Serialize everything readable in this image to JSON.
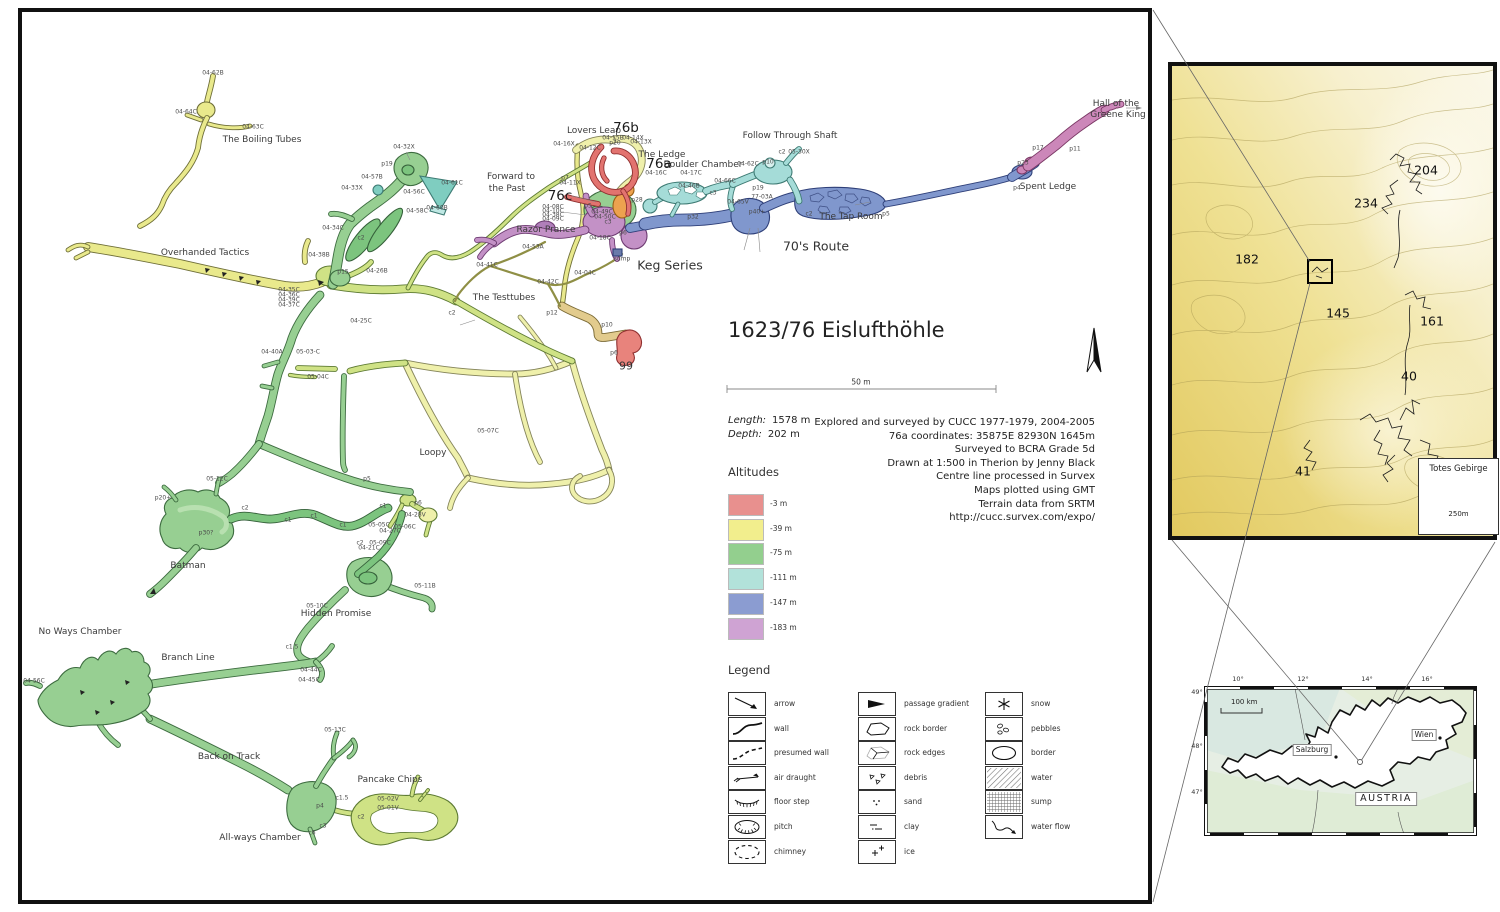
{
  "main_map": {
    "title": "1623/76 Eislufthöhle",
    "scale_label": "50 m",
    "stats": {
      "length_label": "Length:",
      "length_value": "1578 m",
      "depth_label": "Depth:",
      "depth_value": "202 m"
    },
    "credits": [
      "Explored and surveyed by CUCC 1977-1979, 2004-2005",
      "76a coordinates: 35875E 82930N 1645m",
      "Surveyed to BCRA Grade 5d",
      "Drawn at 1:500 in Therion by Jenny Black",
      "Centre line processed in Survex",
      "Maps plotted using GMT",
      "Terrain data from SRTM",
      "http://cucc.survex.com/expo/"
    ],
    "altitudes": {
      "heading": "Altitudes",
      "items": [
        {
          "label": "-3 m",
          "color": "#e8908e"
        },
        {
          "label": "-39 m",
          "color": "#f2ee8d"
        },
        {
          "label": "-75 m",
          "color": "#93cf8e"
        },
        {
          "label": "-111 m",
          "color": "#b2e2da"
        },
        {
          "label": "-147 m",
          "color": "#8b9cd1"
        },
        {
          "label": "-183 m",
          "color": "#cfa3d3"
        }
      ]
    },
    "legend": {
      "heading": "Legend",
      "columns": [
        [
          {
            "icon": "arrow",
            "label": "arrow"
          },
          {
            "icon": "wall",
            "label": "wall"
          },
          {
            "icon": "presumed-wall",
            "label": "presumed wall"
          },
          {
            "icon": "air-draught",
            "label": "air draught"
          },
          {
            "icon": "floor-step",
            "label": "floor step"
          },
          {
            "icon": "pitch",
            "label": "pitch"
          },
          {
            "icon": "chimney",
            "label": "chimney"
          }
        ],
        [
          {
            "icon": "passage-gradient",
            "label": "passage gradient"
          },
          {
            "icon": "rock-border",
            "label": "rock border"
          },
          {
            "icon": "rock-edges",
            "label": "rock edges"
          },
          {
            "icon": "debris",
            "label": "debris"
          },
          {
            "icon": "sand",
            "label": "sand"
          },
          {
            "icon": "clay",
            "label": "clay"
          },
          {
            "icon": "ice",
            "label": "ice"
          }
        ],
        [
          {
            "icon": "snow",
            "label": "snow"
          },
          {
            "icon": "pebbles",
            "label": "pebbles"
          },
          {
            "icon": "border",
            "label": "border"
          },
          {
            "icon": "water",
            "label": "water"
          },
          {
            "icon": "sump",
            "label": "sump"
          },
          {
            "icon": "water-flow",
            "label": "water flow"
          }
        ]
      ]
    },
    "labels": {
      "passages": [
        {
          "t": "The Boiling Tubes",
          "x": 262,
          "y": 140
        },
        {
          "t": "Overhanded Tactics",
          "x": 205,
          "y": 253
        },
        {
          "t": "Forward to",
          "x": 511,
          "y": 177
        },
        {
          "t": "the Past",
          "x": 507,
          "y": 189
        },
        {
          "t": "Lovers Leap",
          "x": 594,
          "y": 131
        },
        {
          "t": "The Ledge",
          "x": 662,
          "y": 155
        },
        {
          "t": "Boulder Chamber",
          "x": 703,
          "y": 165
        },
        {
          "t": "Follow Through Shaft",
          "x": 790,
          "y": 136
        },
        {
          "t": "Razor Prance",
          "x": 546,
          "y": 230
        },
        {
          "t": "The Tap Room",
          "x": 851,
          "y": 217
        },
        {
          "t": "Spent Ledge",
          "x": 1048,
          "y": 187
        },
        {
          "t": "Hall of the",
          "x": 1116,
          "y": 104
        },
        {
          "t": "Greene King",
          "x": 1118,
          "y": 115
        },
        {
          "t": "The Testtubes",
          "x": 504,
          "y": 298
        },
        {
          "t": "Loopy",
          "x": 433,
          "y": 453
        },
        {
          "t": "Batman",
          "x": 188,
          "y": 566
        },
        {
          "t": "Hidden Promise",
          "x": 336,
          "y": 614
        },
        {
          "t": "No Ways Chamber",
          "x": 80,
          "y": 632
        },
        {
          "t": "Branch Line",
          "x": 188,
          "y": 658
        },
        {
          "t": "Back on Track",
          "x": 229,
          "y": 757
        },
        {
          "t": "All-ways Chamber",
          "x": 260,
          "y": 838
        },
        {
          "t": "Pancake Chips",
          "x": 390,
          "y": 780
        }
      ],
      "large": [
        {
          "t": "Keg Series",
          "x": 670,
          "y": 265
        },
        {
          "t": "70's Route",
          "x": 816,
          "y": 246
        }
      ],
      "entrances": [
        {
          "t": "76b",
          "x": 626,
          "y": 128
        },
        {
          "t": "76a",
          "x": 659,
          "y": 164
        },
        {
          "t": "76c",
          "x": 560,
          "y": 196
        }
      ],
      "numbers": [
        {
          "t": "99",
          "x": 626,
          "y": 366
        }
      ],
      "stations": [
        {
          "t": "04-62B",
          "x": 213,
          "y": 73
        },
        {
          "t": "04-64C",
          "x": 186,
          "y": 112
        },
        {
          "t": "04-63C",
          "x": 253,
          "y": 127
        },
        {
          "t": "04-32X",
          "x": 404,
          "y": 147
        },
        {
          "t": "p19",
          "x": 387,
          "y": 164
        },
        {
          "t": "04-57B",
          "x": 372,
          "y": 177
        },
        {
          "t": "04-33X",
          "x": 352,
          "y": 188
        },
        {
          "t": "04-61C",
          "x": 452,
          "y": 183
        },
        {
          "t": "04-56C",
          "x": 414,
          "y": 192
        },
        {
          "t": "04-58C",
          "x": 417,
          "y": 211
        },
        {
          "t": "04-60B",
          "x": 437,
          "y": 208
        },
        {
          "t": "04-34C",
          "x": 333,
          "y": 228
        },
        {
          "t": "c2",
          "x": 361,
          "y": 238
        },
        {
          "t": "04-38B",
          "x": 319,
          "y": 255
        },
        {
          "t": "p15",
          "x": 343,
          "y": 272
        },
        {
          "t": "04-26B",
          "x": 377,
          "y": 271
        },
        {
          "t": "04-35C",
          "x": 289,
          "y": 290
        },
        {
          "t": "04-36C",
          "x": 289,
          "y": 295
        },
        {
          "t": "04-39C",
          "x": 289,
          "y": 300
        },
        {
          "t": "04-37C",
          "x": 289,
          "y": 305
        },
        {
          "t": "04-25C",
          "x": 361,
          "y": 321
        },
        {
          "t": "04-40A",
          "x": 272,
          "y": 352
        },
        {
          "t": "05-03-C",
          "x": 308,
          "y": 352
        },
        {
          "t": "05-04C",
          "x": 318,
          "y": 377
        },
        {
          "t": "c2",
          "x": 452,
          "y": 313
        },
        {
          "t": "04-41C",
          "x": 487,
          "y": 265
        },
        {
          "t": "04-42C",
          "x": 548,
          "y": 282
        },
        {
          "t": "04-04C",
          "x": 585,
          "y": 273
        },
        {
          "t": "p12",
          "x": 552,
          "y": 313
        },
        {
          "t": "p10",
          "x": 607,
          "y": 325
        },
        {
          "t": "p6",
          "x": 614,
          "y": 353
        },
        {
          "t": "05-07C",
          "x": 488,
          "y": 431
        },
        {
          "t": "p5",
          "x": 367,
          "y": 479
        },
        {
          "t": "p6",
          "x": 418,
          "y": 503
        },
        {
          "t": "04-28V",
          "x": 415,
          "y": 515
        },
        {
          "t": "05-05C",
          "x": 379,
          "y": 525
        },
        {
          "t": "05-06C",
          "x": 405,
          "y": 527
        },
        {
          "t": "04-27C",
          "x": 390,
          "y": 531
        },
        {
          "t": "c2",
          "x": 360,
          "y": 543
        },
        {
          "t": "05-09C",
          "x": 380,
          "y": 543
        },
        {
          "t": "04-21C",
          "x": 369,
          "y": 548
        },
        {
          "t": "c1",
          "x": 288,
          "y": 520
        },
        {
          "t": "c1",
          "x": 314,
          "y": 516
        },
        {
          "t": "c1",
          "x": 343,
          "y": 525
        },
        {
          "t": "c1",
          "x": 383,
          "y": 506
        },
        {
          "t": "c2",
          "x": 245,
          "y": 508
        },
        {
          "t": "p20+",
          "x": 163,
          "y": 498
        },
        {
          "t": "p30?",
          "x": 206,
          "y": 533
        },
        {
          "t": "05-12C",
          "x": 217,
          "y": 479
        },
        {
          "t": "05-11B",
          "x": 425,
          "y": 586
        },
        {
          "t": "05-10C",
          "x": 317,
          "y": 606
        },
        {
          "t": "c1.5",
          "x": 292,
          "y": 647
        },
        {
          "t": "04-44C",
          "x": 311,
          "y": 670
        },
        {
          "t": "04-45C",
          "x": 309,
          "y": 680
        },
        {
          "t": "04-56C",
          "x": 34,
          "y": 681
        },
        {
          "t": "05-13C",
          "x": 335,
          "y": 730
        },
        {
          "t": "c1.5",
          "x": 342,
          "y": 798
        },
        {
          "t": "05-02V",
          "x": 388,
          "y": 799
        },
        {
          "t": "05-01V",
          "x": 388,
          "y": 808
        },
        {
          "t": "c2",
          "x": 361,
          "y": 817
        },
        {
          "t": "p4",
          "x": 320,
          "y": 806
        },
        {
          "t": "c3",
          "x": 323,
          "y": 826
        },
        {
          "t": "c6",
          "x": 312,
          "y": 833
        },
        {
          "t": "04-16X",
          "x": 564,
          "y": 144
        },
        {
          "t": "04-12C",
          "x": 590,
          "y": 148
        },
        {
          "t": "04-15B",
          "x": 613,
          "y": 138
        },
        {
          "t": "p20",
          "x": 615,
          "y": 143
        },
        {
          "t": "04-14X",
          "x": 633,
          "y": 138
        },
        {
          "t": "04-13X",
          "x": 641,
          "y": 142
        },
        {
          "t": "p7",
          "x": 565,
          "y": 178
        },
        {
          "t": "04-11X",
          "x": 570,
          "y": 183
        },
        {
          "t": "04-08C",
          "x": 553,
          "y": 207
        },
        {
          "t": "04-10C",
          "x": 553,
          "y": 211
        },
        {
          "t": "04-38C",
          "x": 553,
          "y": 215
        },
        {
          "t": "04-09C",
          "x": 553,
          "y": 219
        },
        {
          "t": "p5",
          "x": 588,
          "y": 206
        },
        {
          "t": "04-49C",
          "x": 602,
          "y": 212
        },
        {
          "t": "04-50C",
          "x": 605,
          "y": 217
        },
        {
          "t": "c3",
          "x": 608,
          "y": 222
        },
        {
          "t": "04-18C",
          "x": 600,
          "y": 238
        },
        {
          "t": "p6",
          "x": 623,
          "y": 233
        },
        {
          "t": "sump",
          "x": 622,
          "y": 259
        },
        {
          "t": "04-53A",
          "x": 533,
          "y": 247
        },
        {
          "t": "04-16C",
          "x": 656,
          "y": 173
        },
        {
          "t": "04-17C",
          "x": 691,
          "y": 173
        },
        {
          "t": "04-46B",
          "x": 689,
          "y": 186
        },
        {
          "t": "p28",
          "x": 637,
          "y": 200
        },
        {
          "t": "p32",
          "x": 693,
          "y": 217
        },
        {
          "t": "04-62C",
          "x": 748,
          "y": 164
        },
        {
          "t": "04-66C",
          "x": 725,
          "y": 181
        },
        {
          "t": "p10",
          "x": 768,
          "y": 162
        },
        {
          "t": "c3",
          "x": 713,
          "y": 193
        },
        {
          "t": "p19",
          "x": 758,
          "y": 188
        },
        {
          "t": "77-03A",
          "x": 762,
          "y": 197
        },
        {
          "t": "p40+",
          "x": 757,
          "y": 212
        },
        {
          "t": "04-65V",
          "x": 738,
          "y": 202
        },
        {
          "t": "c2",
          "x": 782,
          "y": 152
        },
        {
          "t": "05-30X",
          "x": 799,
          "y": 152
        },
        {
          "t": "c2",
          "x": 809,
          "y": 214
        },
        {
          "t": "p5",
          "x": 886,
          "y": 214
        },
        {
          "t": "p23",
          "x": 1023,
          "y": 163
        },
        {
          "t": "p4",
          "x": 1017,
          "y": 188
        },
        {
          "t": "p17",
          "x": 1038,
          "y": 148
        },
        {
          "t": "p11",
          "x": 1075,
          "y": 149
        }
      ]
    }
  },
  "topo_inset": {
    "numbers": [
      {
        "t": "204",
        "x": 1426,
        "y": 170
      },
      {
        "t": "234",
        "x": 1366,
        "y": 203
      },
      {
        "t": "182",
        "x": 1247,
        "y": 259
      },
      {
        "t": "145",
        "x": 1338,
        "y": 313
      },
      {
        "t": "161",
        "x": 1432,
        "y": 321
      },
      {
        "t": "40",
        "x": 1409,
        "y": 376
      },
      {
        "t": "41",
        "x": 1303,
        "y": 471
      }
    ],
    "box": {
      "title": "Totes Gebirge",
      "scale": "250m"
    }
  },
  "austria_inset": {
    "lon_ticks": [
      {
        "t": "10°",
        "x": 1238
      },
      {
        "t": "12°",
        "x": 1303
      },
      {
        "t": "14°",
        "x": 1367
      },
      {
        "t": "16°",
        "x": 1427
      }
    ],
    "lat_ticks": [
      {
        "t": "49°",
        "y": 692
      },
      {
        "t": "48°",
        "y": 746
      },
      {
        "t": "47°",
        "y": 792
      }
    ],
    "scale": "100 km",
    "places": [
      {
        "t": "Salzburg",
        "x": 1312,
        "y": 750,
        "big": false
      },
      {
        "t": "Wien",
        "x": 1424,
        "y": 735,
        "big": false
      },
      {
        "t": "AUSTRIA",
        "x": 1386,
        "y": 799,
        "big": true
      }
    ]
  },
  "colors": {
    "depth_minus3": "#e8908e",
    "depth_minus39": "#f2ee8d",
    "depth_minus75": "#93cf8e",
    "depth_minus111": "#b2e2da",
    "depth_minus147": "#8b9cd1",
    "depth_minus183": "#cfa3d3",
    "terrain_low": "#e5cf72",
    "terrain_high": "#faf6e6"
  }
}
